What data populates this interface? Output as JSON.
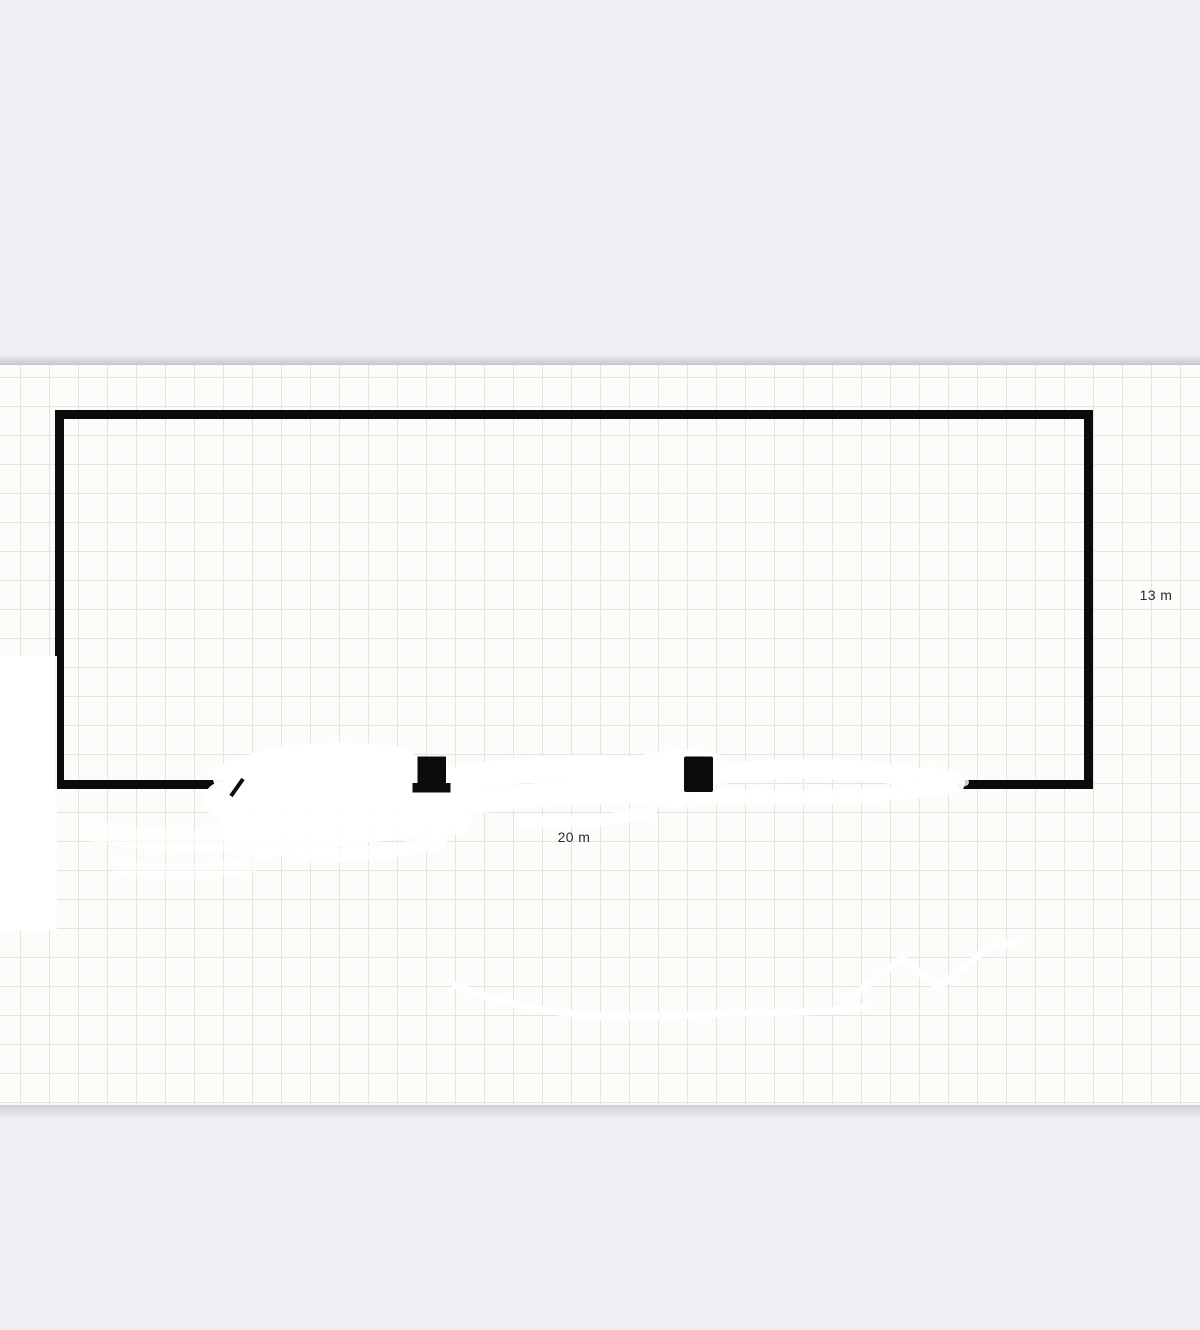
{
  "app": {
    "canvas_background": "#fcfcfb",
    "margin_background": "#f0eff4",
    "grid_line_color": "#e6e5da",
    "grid_cell_px": 29,
    "wall_color": "#0b0b0b",
    "eraser_color": "#ffffff",
    "label_color": "#2d2d2d"
  },
  "floorplan": {
    "room": {
      "height_label": "13 m",
      "width_label": "20 m"
    },
    "fixtures": [
      {
        "icon": "fixture-marker-icon",
        "shape": "pedestal-with-base"
      },
      {
        "icon": "fixture-marker-icon",
        "shape": "block"
      }
    ]
  }
}
